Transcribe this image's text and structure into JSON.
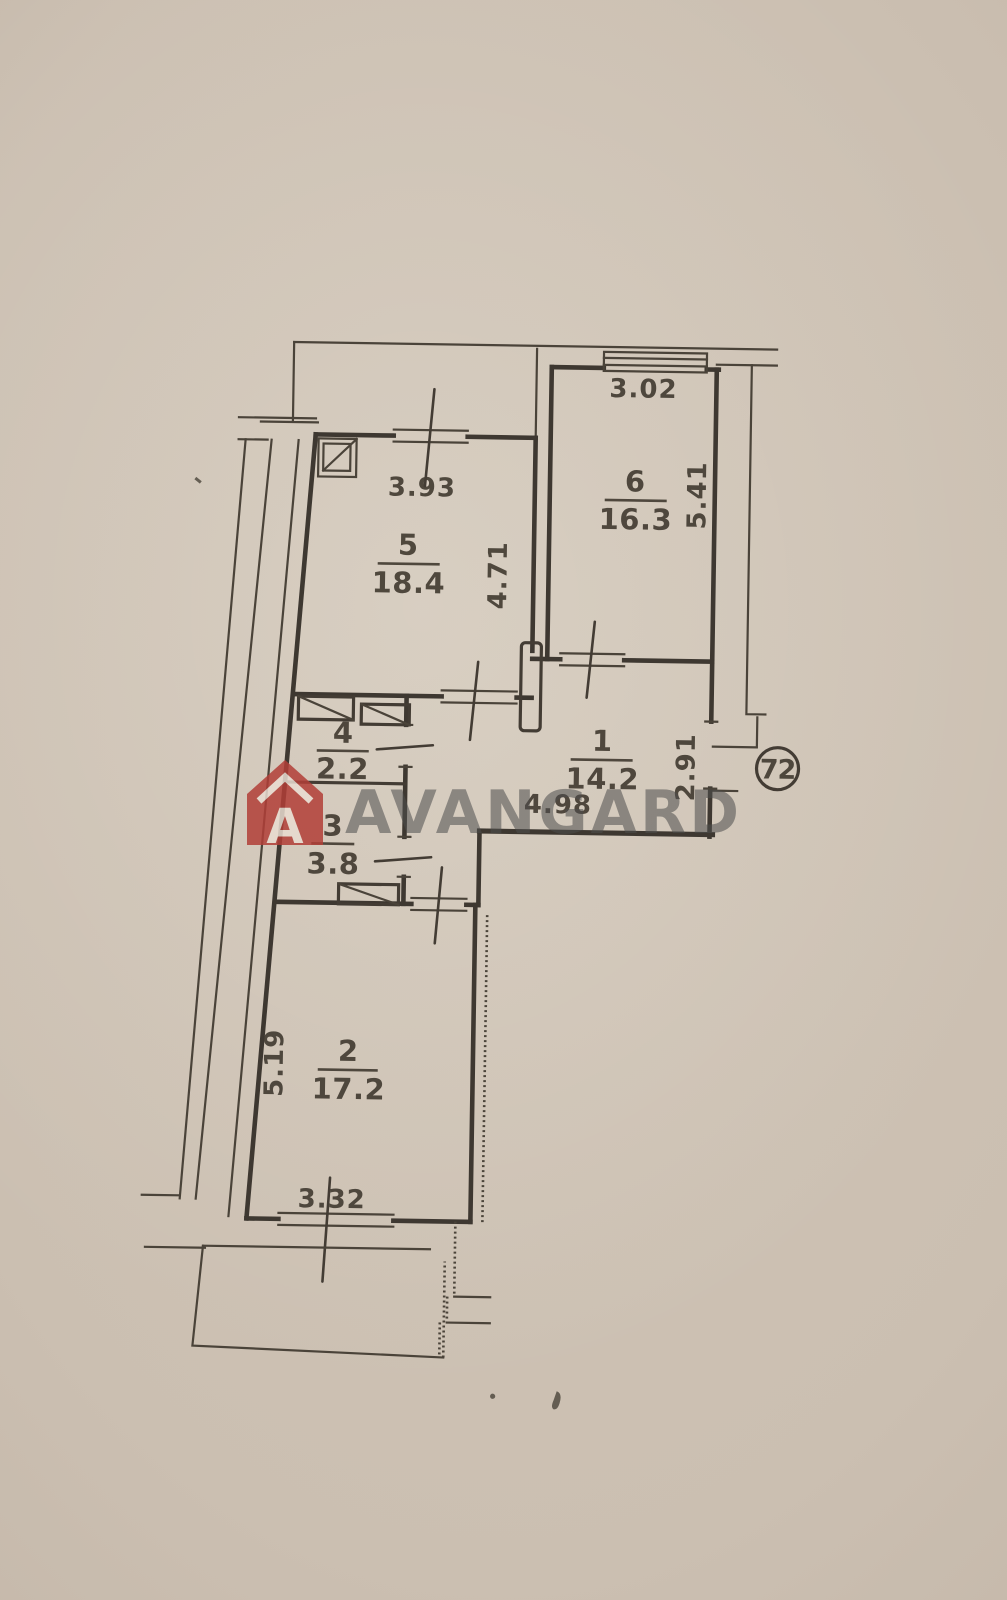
{
  "document": {
    "type_label": "floor-plan-photo"
  },
  "apartment": {
    "number": "72"
  },
  "rooms": {
    "r1": {
      "number": "1",
      "area": "14.2",
      "width": "4.98",
      "depth": "2.91"
    },
    "r2": {
      "number": "2",
      "area": "17.2",
      "width": "3.32",
      "depth": "5.19"
    },
    "r3": {
      "number": "3",
      "area": "3.8"
    },
    "r4": {
      "number": "4",
      "area": "2.2"
    },
    "r5": {
      "number": "5",
      "area": "18.4",
      "width": "3.93",
      "depth": "4.71"
    },
    "r6": {
      "number": "6",
      "area": "16.3",
      "width": "3.02",
      "depth": "5.41"
    }
  },
  "watermark": {
    "text": "AVANGARD",
    "logo_letter": "A",
    "logo_icon": "avangard-house-logo-icon"
  },
  "colors": {
    "paper": "#cbbfb1",
    "ink": "#3e3831",
    "watermark_red": "#b23f38",
    "watermark_gray": "#4e4e4e"
  }
}
